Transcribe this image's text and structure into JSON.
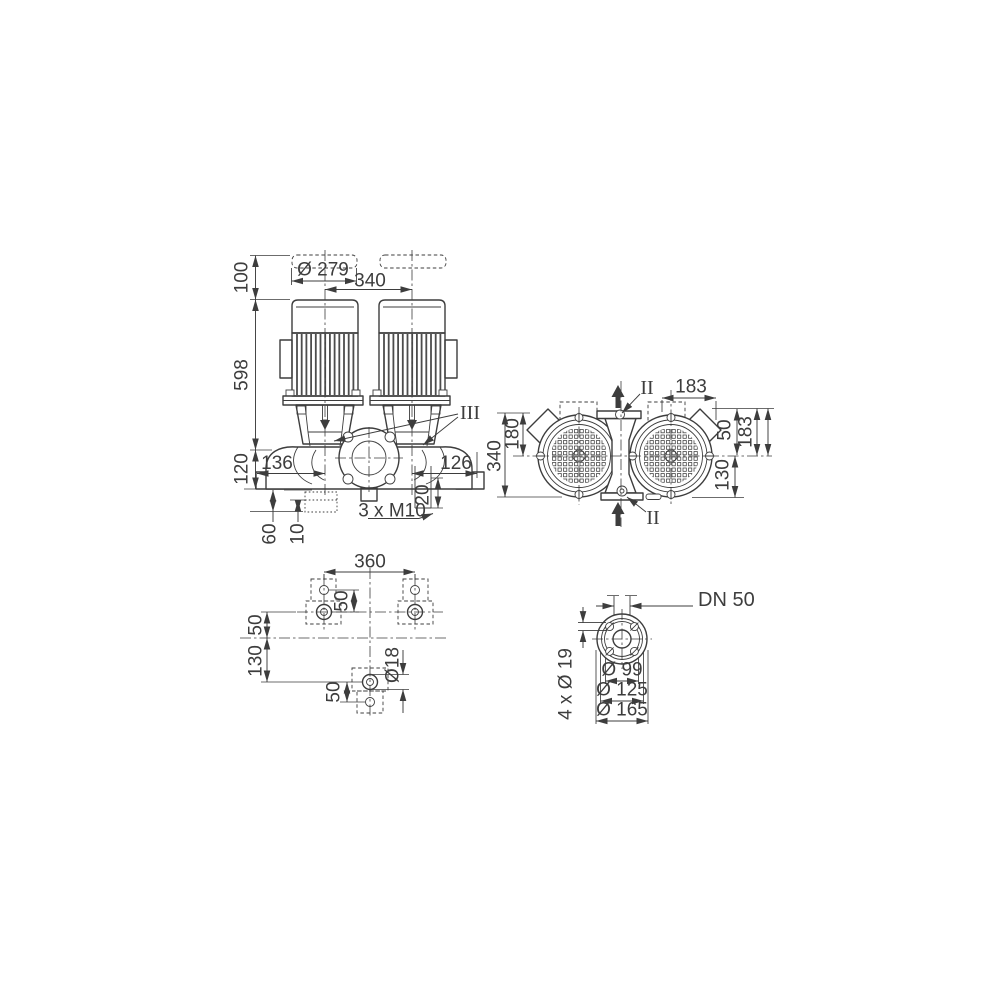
{
  "drawing": {
    "type": "pump dimension drawing",
    "colors": {
      "ink": "#3d3d3d",
      "paper": "#ffffff"
    },
    "front": {
      "top_clearance": "100",
      "unit_height": "598",
      "base_height": "120",
      "motor_diameter": "Ø 279",
      "motor_spacing": "340",
      "left_offset": "136",
      "right_offset": "126",
      "boss_depth": "20",
      "thread_callout": "3 x M10",
      "foot_height": "60",
      "pad_height": "10",
      "detail_marker": "III"
    },
    "top": {
      "overall_depth": "340",
      "axis_depth": "180",
      "box_span_top": "183",
      "port_offset": "50",
      "box_span_right": "183",
      "flange_offset": "130",
      "section_marker_top": "II",
      "section_marker_bottom": "II"
    },
    "plan": {
      "foot_span": "360",
      "hole_pitch_top": "50",
      "axis_offset": "50",
      "foot_distance": "130",
      "hole_pitch_bottom": "50",
      "hole_diameter": "Ø18"
    },
    "flange": {
      "nominal_diameter": "DN 50",
      "pilot_diameter": "Ø 99",
      "bolt_circle_diameter": "Ø 125",
      "outer_diameter": "Ø 165",
      "bolt_hole_callout": "4 x Ø 19"
    }
  }
}
